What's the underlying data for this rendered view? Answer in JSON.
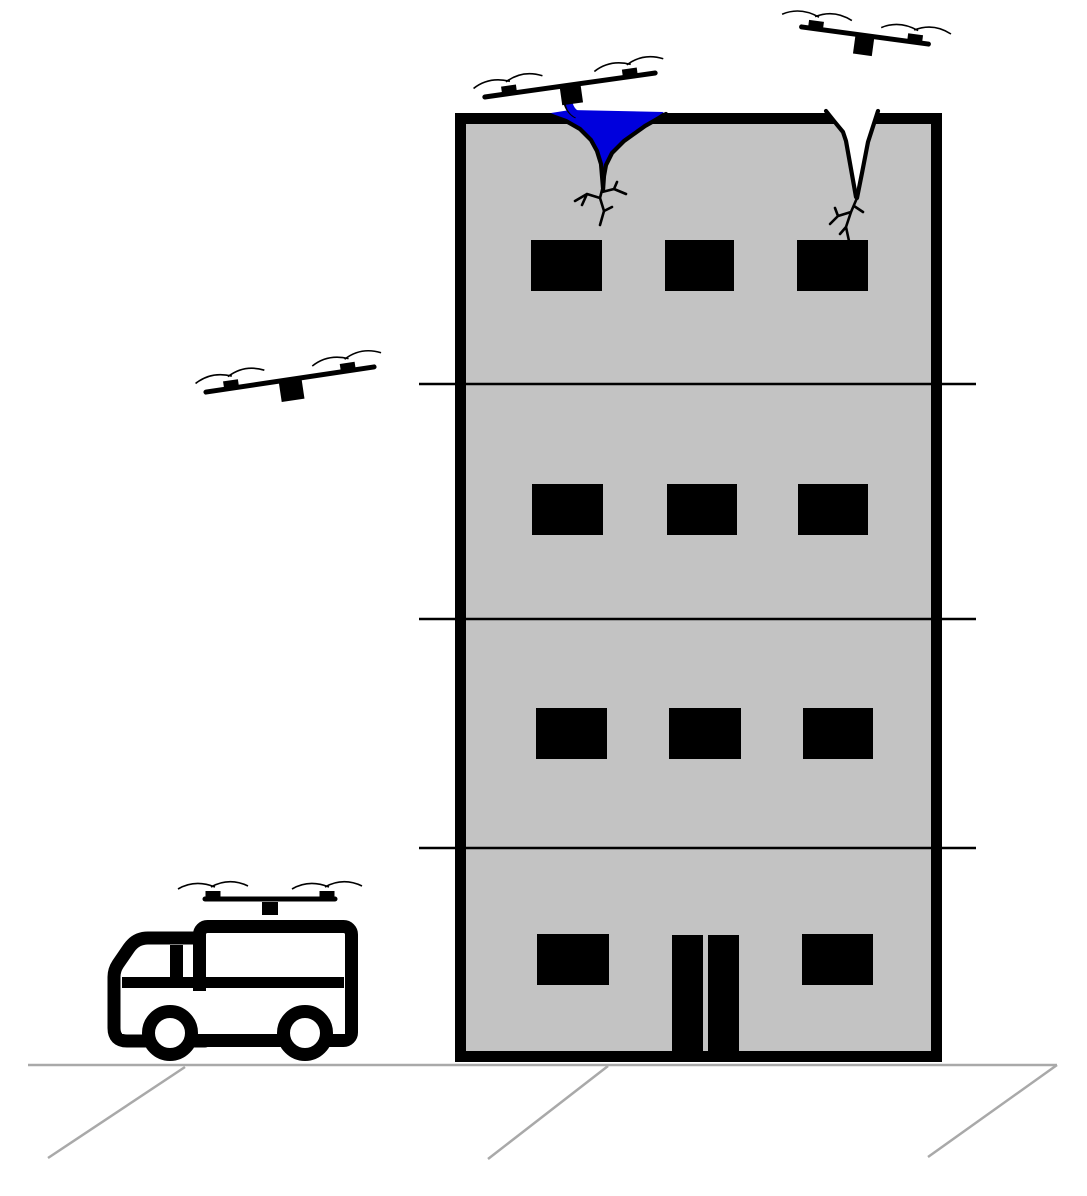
{
  "meta": {
    "description": "Schematic figure: a swarm of quadcopter drones repairing cracks on a four-storey building; one drone deposits blue sealant into a roof crack, one hovers over an open crack, one is in flight, and one is docked on a support truck parked on the ground.",
    "canvas": {
      "width": 1087,
      "height": 1196
    },
    "background": "#ffffff"
  },
  "palette": {
    "outline": "#000000",
    "building_fill": "#c3c3c3",
    "sealant_blue": "#0000dd",
    "ground_gray": "#a9a9a9",
    "white": "#ffffff"
  },
  "building": {
    "floors": 4,
    "frame": {
      "x": 460.5,
      "y": 118.5,
      "w": 476,
      "h": 938,
      "border": 11
    },
    "floor_lines": {
      "ys": [
        384,
        619,
        848
      ],
      "x1": 419,
      "x2": 976,
      "width": 2.5
    },
    "windows": {
      "rows": [
        {
          "y": 240,
          "h": 51,
          "cols": [
            [
              531,
              71
            ],
            [
              665,
              69
            ],
            [
              797,
              71
            ]
          ]
        },
        {
          "y": 484,
          "h": 51,
          "cols": [
            [
              532,
              71
            ],
            [
              667,
              70
            ],
            [
              798,
              70
            ]
          ]
        },
        {
          "y": 708,
          "h": 51,
          "cols": [
            [
              536,
              71
            ],
            [
              669,
              72
            ],
            [
              803,
              70
            ]
          ]
        },
        {
          "y": 934,
          "h": 51,
          "cols": [
            [
              537,
              72
            ],
            [
              802,
              71
            ]
          ]
        }
      ]
    },
    "door": {
      "leaves": [
        [
          672,
          935,
          31,
          116
        ],
        [
          708,
          935,
          31,
          116
        ]
      ]
    }
  },
  "cracks": [
    {
      "name": "crack-sealed",
      "status": "being filled with sealant",
      "pool_points": "551,113 570,110 664,112 645,125 624,140 611,153 605,166 603,187 600,165 596,150 589,138 577,127 562,119",
      "edge_left": "M552,116 L566,121 L580,129 L591,140 L597,151 L601,164 L603,188",
      "edge_right": "M666,114 L645,126 L624,141 L612,153 L606,165 L604,176 L603,190",
      "spout_outline": "M564,99 Q565,111 575,117",
      "spout_stream": "M569,100 Q569,112 581,116",
      "branches": "M603,186 L600,198 L604,211 L600,225 M600,198 L587,194 L575,201 M587,194 L582,205 M602,192 L614,189 L626,194 M614,189 L617,182 M604,211 L612,207"
    },
    {
      "name": "crack-open",
      "status": "unrepaired",
      "wedge_points": "826,107 879,107 876,113 868,141 861,173 857,198 851,168 845,139 842,129 833,119 827,112",
      "edge_left": "M826,111 L834,121 L843,132 L846,141 L851,169 L856,197",
      "edge_right": "M878,111 L868,142 L862,173 L857,198",
      "branches": "M857,198 L851,212 L846,227 L849,241 M851,212 L838,216 L830,224 M838,216 L835,208 M854,206 L863,212 M846,227 L840,234"
    }
  ],
  "drones": [
    {
      "name": "drone-sealing",
      "role": "depositing sealant into roof crack",
      "cx": 570,
      "cy": 85,
      "angle": -8,
      "half": 86,
      "hub_inset": 25,
      "body": [
        21,
        18,
        3
      ]
    },
    {
      "name": "drone-inspecting",
      "role": "hovering above open crack",
      "cx": 865,
      "cy": 35.5,
      "angle": 7.7,
      "half": 64,
      "hub_inset": 14,
      "body": [
        19,
        19,
        2.5
      ]
    },
    {
      "name": "drone-approaching",
      "role": "in flight toward building",
      "cx": 290,
      "cy": 379.5,
      "angle": -8.5,
      "half": 85,
      "hub_inset": 26,
      "body": [
        23,
        21,
        2
      ]
    },
    {
      "name": "drone-docked",
      "role": "parked on support truck roof",
      "cx": 270,
      "cy": 899,
      "angle": 0,
      "half": 65,
      "hub_inset": 8,
      "body": [
        16,
        13,
        5
      ]
    }
  ],
  "drone_style": {
    "bar_stroke": 5,
    "hub_w": 15,
    "hub_h": 6.5,
    "blade1": "M-35,-2 Q-18,-12 2,-4",
    "blade2": "M-2,-4 Q16,-14 35,-5",
    "blade_stroke": 1.6
  },
  "truck": {
    "cab_path": "M205,938 L148,938 Q136,938 129,948 L118,964 Q114,970 114,977 L114,1028 Q114,1041 127,1041 L205,1041 Z",
    "box": {
      "x": 199.5,
      "y": 926.5,
      "w": 152,
      "h": 114,
      "r": 8,
      "stroke": 13
    },
    "band": {
      "x": 122,
      "y": 977,
      "w": 222,
      "h": 11
    },
    "pillar": {
      "x": 170,
      "y": 945,
      "w": 13,
      "h": 43
    },
    "chassis_clear": {
      "x": 122,
      "y": 991,
      "w": 223,
      "h": 43
    },
    "wheels": [
      {
        "cx": 170,
        "cy": 1033
      },
      {
        "cx": 305,
        "cy": 1033
      }
    ],
    "wheel": {
      "r": 21.5,
      "stroke": 13
    }
  },
  "ground": {
    "line": {
      "x1": 28,
      "x2": 1057,
      "y": 1065,
      "width": 2.5
    },
    "hatches": [
      [
        185,
        1067,
        48,
        1158
      ],
      [
        608,
        1066,
        488,
        1159
      ],
      [
        1057,
        1065,
        928,
        1157
      ]
    ]
  }
}
